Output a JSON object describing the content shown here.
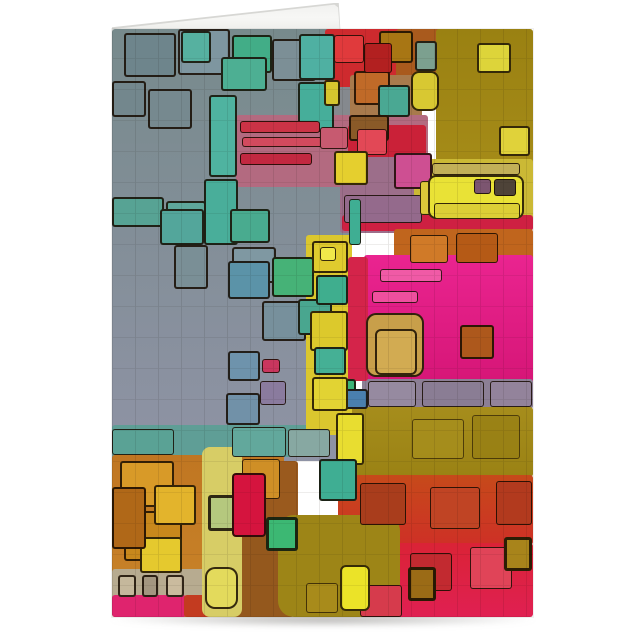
{
  "scene": {
    "description": "Folded greeting card product photo standing upright on a white background; front panel shows abstract posterized artwork of overlapping black-outlined color squares; white back panel peeks above the top fold as a thin wedge; soft shadow under the bottom edge",
    "background_color": "#ffffff",
    "card": {
      "left": 112,
      "top": 29,
      "width": 421,
      "height": 588
    },
    "back_fold": {
      "left": 112,
      "top": 3,
      "width": 230,
      "height": 27,
      "face_color": "#f7f7f5",
      "edge_color": "#d7d7d4"
    },
    "shadow": {
      "left": 110,
      "top": 612,
      "width": 426,
      "height": 15,
      "color": "rgba(118,116,112,0.55)"
    }
  },
  "palette": {
    "slate_gray": "#7b8a8c",
    "lavender_gray": "#8f93a5",
    "teal": "#4fae93",
    "green": "#46b277",
    "blue_gray": "#5b93a8",
    "yellow": "#e5d52f",
    "pale_yellow": "#d7cd66",
    "olive_gold": "#9d8415",
    "orange": "#c0651d",
    "red": "#ce2a2e",
    "crimson": "#d5143e",
    "hot_pink": "#e92390",
    "mauve": "#b36a80",
    "purple_gray": "#8c7f95",
    "tan": "#c89f4a",
    "brown": "#94581d",
    "beige": "#b7ab90",
    "ink_outline": "rgba(22,11,0,0.85)"
  },
  "art": {
    "canvas": {
      "w": 421,
      "h": 588
    },
    "outline": "rgba(22,11,0,0.85)",
    "patches": [
      {
        "x": 0,
        "y": 0,
        "w": 238,
        "h": 432,
        "c": "#778a8c",
        "c2": "#8f93a5"
      },
      {
        "x": 220,
        "y": 0,
        "w": 72,
        "h": 100,
        "c": "#85898e"
      },
      {
        "x": 213,
        "y": 0,
        "w": 82,
        "h": 58,
        "c": "#ce2a2e"
      },
      {
        "x": 284,
        "y": 0,
        "w": 64,
        "h": 48,
        "c": "#a95a1d"
      },
      {
        "x": 324,
        "y": 0,
        "w": 97,
        "h": 192,
        "c": "#9a8112",
        "c2": "#a98f1a"
      },
      {
        "x": 238,
        "y": 46,
        "w": 72,
        "h": 46,
        "c": "#a87a4c"
      },
      {
        "x": 124,
        "y": 86,
        "w": 192,
        "h": 72,
        "c": "#b36a80"
      },
      {
        "x": 236,
        "y": 96,
        "w": 78,
        "h": 34,
        "c": "#ca2138"
      },
      {
        "x": 228,
        "y": 128,
        "w": 88,
        "h": 76,
        "c": "#9c6e8a"
      },
      {
        "x": 302,
        "y": 130,
        "w": 119,
        "h": 64,
        "c": "#cbb935"
      },
      {
        "x": 230,
        "y": 186,
        "w": 191,
        "h": 16,
        "c": "#ce2042"
      },
      {
        "x": 282,
        "y": 200,
        "w": 139,
        "h": 40,
        "c": "#c0651d"
      },
      {
        "x": 252,
        "y": 226,
        "w": 169,
        "h": 128,
        "c": "#ea2490",
        "c2": "#d61677"
      },
      {
        "x": 250,
        "y": 350,
        "w": 171,
        "h": 30,
        "c": "#8c7f95"
      },
      {
        "x": 226,
        "y": 378,
        "w": 195,
        "h": 70,
        "c": "#a68d1c",
        "c2": "#9a8214"
      },
      {
        "x": 226,
        "y": 446,
        "w": 195,
        "h": 70,
        "c": "#c64a1a",
        "c2": "#ce3026"
      },
      {
        "x": 226,
        "y": 514,
        "w": 195,
        "h": 74,
        "c": "#da2336",
        "c2": "#e02052"
      },
      {
        "x": 0,
        "y": 396,
        "w": 206,
        "h": 32,
        "c": "#5f9e96"
      },
      {
        "x": 0,
        "y": 426,
        "w": 172,
        "h": 162,
        "c": "#c07622",
        "c2": "#c98429"
      },
      {
        "x": 0,
        "y": 540,
        "w": 94,
        "h": 30,
        "c": "#b7ab90"
      },
      {
        "x": 0,
        "y": 566,
        "w": 74,
        "h": 22,
        "c": "#df246e"
      },
      {
        "x": 72,
        "y": 566,
        "w": 100,
        "h": 22,
        "c": "#c33b20"
      },
      {
        "x": 118,
        "y": 498,
        "w": 64,
        "h": 90,
        "c": "#94581d"
      },
      {
        "x": 150,
        "y": 432,
        "w": 36,
        "h": 70,
        "c": "#9a5a1e"
      },
      {
        "x": 166,
        "y": 486,
        "w": 122,
        "h": 102,
        "c": "#9d8517",
        "r": 16
      },
      {
        "x": 194,
        "y": 206,
        "w": 46,
        "h": 200,
        "c": "#dbc72e"
      },
      {
        "x": 236,
        "y": 228,
        "w": 20,
        "h": 124,
        "c": "#d4244a"
      },
      {
        "x": 90,
        "y": 418,
        "w": 40,
        "h": 170,
        "c": "#d7cd66",
        "r": 8
      }
    ],
    "blocks": [
      {
        "x": 12,
        "y": 4,
        "w": 52,
        "h": 44,
        "c": "#6e858c"
      },
      {
        "x": 66,
        "y": 0,
        "w": 52,
        "h": 46,
        "c": "#7e96a0"
      },
      {
        "x": 69,
        "y": 2,
        "w": 30,
        "h": 32,
        "c": "#56b1a0"
      },
      {
        "x": 120,
        "y": 6,
        "w": 40,
        "h": 38,
        "c": "#42ad87"
      },
      {
        "x": 109,
        "y": 28,
        "w": 46,
        "h": 34,
        "c": "#4daf93"
      },
      {
        "x": 0,
        "y": 52,
        "w": 34,
        "h": 36,
        "c": "#73878d"
      },
      {
        "x": 36,
        "y": 60,
        "w": 44,
        "h": 40,
        "c": "#76898f"
      },
      {
        "x": 160,
        "y": 10,
        "w": 44,
        "h": 42,
        "c": "#7c8f96"
      },
      {
        "x": 187,
        "y": 5,
        "w": 36,
        "h": 46,
        "c": "#4fb0a2"
      },
      {
        "x": 186,
        "y": 53,
        "w": 36,
        "h": 50,
        "c": "#46ae9a"
      },
      {
        "x": 212,
        "y": 51,
        "w": 16,
        "h": 26,
        "c": "#d6c52e"
      },
      {
        "x": 242,
        "y": 42,
        "w": 36,
        "h": 34,
        "c": "#c06a28"
      },
      {
        "x": 267,
        "y": 2,
        "w": 34,
        "h": 32,
        "c": "#a87614"
      },
      {
        "x": 266,
        "y": 56,
        "w": 32,
        "h": 32,
        "c": "#4aa893"
      },
      {
        "x": 237,
        "y": 86,
        "w": 40,
        "h": 26,
        "c": "#8a5a28"
      },
      {
        "x": 222,
        "y": 6,
        "w": 30,
        "h": 28,
        "c": "#e03a3c",
        "bw": 1
      },
      {
        "x": 252,
        "y": 14,
        "w": 28,
        "h": 30,
        "c": "#b22020",
        "bw": 1
      },
      {
        "x": 365,
        "y": 14,
        "w": 34,
        "h": 30,
        "c": "#ddd43a"
      },
      {
        "x": 387,
        "y": 97,
        "w": 31,
        "h": 30,
        "c": "#e0d23a"
      },
      {
        "x": 303,
        "y": 12,
        "w": 22,
        "h": 30,
        "c": "#7ca08f"
      },
      {
        "x": 299,
        "y": 42,
        "w": 28,
        "h": 40,
        "c": "#d8c832",
        "r": 8
      },
      {
        "x": 0,
        "y": 168,
        "w": 52,
        "h": 30,
        "c": "#57a394"
      },
      {
        "x": 54,
        "y": 172,
        "w": 40,
        "h": 26,
        "c": "#5ea79a"
      },
      {
        "x": 97,
        "y": 66,
        "w": 28,
        "h": 82,
        "c": "#4fb3a0"
      },
      {
        "x": 92,
        "y": 150,
        "w": 34,
        "h": 66,
        "c": "#49ae9a"
      },
      {
        "x": 48,
        "y": 180,
        "w": 44,
        "h": 36,
        "c": "#53a69b"
      },
      {
        "x": 62,
        "y": 216,
        "w": 34,
        "h": 44,
        "c": "#7a8f96"
      },
      {
        "x": 118,
        "y": 180,
        "w": 40,
        "h": 34,
        "c": "#49ab8f"
      },
      {
        "x": 120,
        "y": 218,
        "w": 44,
        "h": 36,
        "c": "#7f98a2"
      },
      {
        "x": 128,
        "y": 92,
        "w": 80,
        "h": 12,
        "c": "#cb3346",
        "bw": 1
      },
      {
        "x": 130,
        "y": 108,
        "w": 88,
        "h": 10,
        "c": "#d24a5e",
        "bw": 1
      },
      {
        "x": 128,
        "y": 124,
        "w": 72,
        "h": 12,
        "c": "#c22840",
        "bw": 1
      },
      {
        "x": 208,
        "y": 98,
        "w": 28,
        "h": 22,
        "c": "#c75a70",
        "bw": 1
      },
      {
        "x": 245,
        "y": 100,
        "w": 30,
        "h": 26,
        "c": "#e24856",
        "bw": 1
      },
      {
        "x": 222,
        "y": 122,
        "w": 34,
        "h": 34,
        "c": "#e5cf2e"
      },
      {
        "x": 282,
        "y": 124,
        "w": 38,
        "h": 36,
        "c": "#ce4f92"
      },
      {
        "x": 232,
        "y": 166,
        "w": 78,
        "h": 28,
        "c": "#946a8c",
        "bw": 1
      },
      {
        "x": 308,
        "y": 152,
        "w": 16,
        "h": 34,
        "c": "#ddc93a",
        "bw": 1
      },
      {
        "x": 237,
        "y": 170,
        "w": 12,
        "h": 46,
        "c": "#3fae93",
        "bw": 1
      },
      {
        "x": 316,
        "y": 146,
        "w": 96,
        "h": 44,
        "c": "#e9e236",
        "r": 8
      },
      {
        "x": 322,
        "y": 174,
        "w": 86,
        "h": 16,
        "c": "#dccf36",
        "bw": 1
      },
      {
        "x": 362,
        "y": 150,
        "w": 17,
        "h": 15,
        "c": "#7c5570",
        "bw": 1
      },
      {
        "x": 382,
        "y": 150,
        "w": 22,
        "h": 17,
        "c": "#4e4338",
        "bw": 1
      },
      {
        "x": 320,
        "y": 134,
        "w": 88,
        "h": 12,
        "c": "#c2b058",
        "bw": 1
      },
      {
        "x": 298,
        "y": 206,
        "w": 38,
        "h": 28,
        "c": "#d07a28",
        "bw": 1
      },
      {
        "x": 344,
        "y": 204,
        "w": 42,
        "h": 30,
        "c": "#b55a16",
        "bw": 1
      },
      {
        "x": 268,
        "y": 240,
        "w": 62,
        "h": 13,
        "c": "#f05aa6",
        "bw": 1
      },
      {
        "x": 260,
        "y": 262,
        "w": 46,
        "h": 12,
        "c": "#ef4f9e",
        "bw": 1
      },
      {
        "x": 254,
        "y": 284,
        "w": 58,
        "h": 64,
        "c": "#c89f4a",
        "r": 10
      },
      {
        "x": 263,
        "y": 300,
        "w": 42,
        "h": 46,
        "c": "#d2ab52",
        "r": 6
      },
      {
        "x": 348,
        "y": 296,
        "w": 34,
        "h": 34,
        "c": "#ad581c"
      },
      {
        "x": 256,
        "y": 352,
        "w": 48,
        "h": 26,
        "c": "#968aa0",
        "bw": 1
      },
      {
        "x": 310,
        "y": 352,
        "w": 62,
        "h": 26,
        "c": "#8a7d94",
        "bw": 1
      },
      {
        "x": 378,
        "y": 352,
        "w": 42,
        "h": 26,
        "c": "#93839b",
        "bw": 1
      },
      {
        "x": 218,
        "y": 350,
        "w": 26,
        "h": 22,
        "c": "#3db377"
      },
      {
        "x": 232,
        "y": 360,
        "w": 24,
        "h": 20,
        "c": "#4a7fae"
      },
      {
        "x": 224,
        "y": 384,
        "w": 28,
        "h": 52,
        "c": "#e8dd30"
      },
      {
        "x": 207,
        "y": 430,
        "w": 38,
        "h": 42,
        "c": "#3fae93"
      },
      {
        "x": 300,
        "y": 390,
        "w": 52,
        "h": 40,
        "c": "#a8901e",
        "bw": 1,
        "o": 0.7
      },
      {
        "x": 360,
        "y": 386,
        "w": 48,
        "h": 44,
        "c": "#977f14",
        "bw": 1,
        "o": 0.7
      },
      {
        "x": 248,
        "y": 454,
        "w": 46,
        "h": 42,
        "c": "#a93d1c",
        "bw": 1
      },
      {
        "x": 318,
        "y": 458,
        "w": 50,
        "h": 42,
        "c": "#c04424",
        "bw": 1
      },
      {
        "x": 384,
        "y": 452,
        "w": 36,
        "h": 44,
        "c": "#b23a1e",
        "bw": 1
      },
      {
        "x": 298,
        "y": 524,
        "w": 42,
        "h": 38,
        "c": "#c22a30",
        "bw": 1
      },
      {
        "x": 358,
        "y": 518,
        "w": 42,
        "h": 42,
        "c": "#e04458",
        "bw": 1
      },
      {
        "x": 392,
        "y": 508,
        "w": 28,
        "h": 34,
        "c": "#a8841b",
        "bw": 3
      },
      {
        "x": 296,
        "y": 538,
        "w": 28,
        "h": 34,
        "c": "#9b6b16",
        "bw": 3
      },
      {
        "x": 248,
        "y": 556,
        "w": 42,
        "h": 32,
        "c": "#d63b4c",
        "bw": 1
      },
      {
        "x": 154,
        "y": 488,
        "w": 32,
        "h": 34,
        "c": "#3cb873",
        "bw": 3
      },
      {
        "x": 228,
        "y": 536,
        "w": 30,
        "h": 46,
        "c": "#ebe328",
        "r": 6
      },
      {
        "x": 194,
        "y": 554,
        "w": 32,
        "h": 30,
        "c": "#ab8d1c",
        "bw": 1,
        "o": 0.8
      },
      {
        "x": 8,
        "y": 432,
        "w": 54,
        "h": 46,
        "c": "#d89a28"
      },
      {
        "x": 12,
        "y": 482,
        "w": 58,
        "h": 50,
        "c": "#c8881c"
      },
      {
        "x": 42,
        "y": 456,
        "w": 42,
        "h": 40,
        "c": "#e3b42c"
      },
      {
        "x": 28,
        "y": 508,
        "w": 42,
        "h": 36,
        "c": "#e5c92e"
      },
      {
        "x": 0,
        "y": 458,
        "w": 34,
        "h": 62,
        "c": "#b06818"
      },
      {
        "x": 130,
        "y": 430,
        "w": 38,
        "h": 40,
        "c": "#cf8f26",
        "bw": 1
      },
      {
        "x": 6,
        "y": 546,
        "w": 18,
        "h": 22,
        "c": "#c5b89c"
      },
      {
        "x": 30,
        "y": 546,
        "w": 16,
        "h": 22,
        "c": "#a39680"
      },
      {
        "x": 54,
        "y": 546,
        "w": 18,
        "h": 22,
        "c": "#cabb9e"
      },
      {
        "x": 96,
        "y": 466,
        "w": 30,
        "h": 36,
        "c": "#b5c87e",
        "bw": 3
      },
      {
        "x": 93,
        "y": 538,
        "w": 33,
        "h": 42,
        "c": "#e3da5c",
        "r": 10
      },
      {
        "x": 120,
        "y": 444,
        "w": 34,
        "h": 64,
        "c": "#d5143e",
        "r": 4
      },
      {
        "x": 0,
        "y": 400,
        "w": 62,
        "h": 26,
        "c": "#5aa295",
        "bw": 1
      },
      {
        "x": 120,
        "y": 398,
        "w": 54,
        "h": 30,
        "c": "#62a89c",
        "bw": 1
      },
      {
        "x": 176,
        "y": 400,
        "w": 42,
        "h": 28,
        "c": "#87a8a2",
        "bw": 1
      },
      {
        "x": 116,
        "y": 322,
        "w": 32,
        "h": 30,
        "c": "#6e93ac"
      },
      {
        "x": 114,
        "y": 364,
        "w": 34,
        "h": 32,
        "c": "#7191a8"
      },
      {
        "x": 150,
        "y": 330,
        "w": 18,
        "h": 14,
        "c": "#c9365e",
        "bw": 1
      },
      {
        "x": 148,
        "y": 352,
        "w": 26,
        "h": 24,
        "c": "#8a7b9e",
        "bw": 1
      },
      {
        "x": 116,
        "y": 232,
        "w": 42,
        "h": 38,
        "c": "#5b93a8"
      },
      {
        "x": 160,
        "y": 228,
        "w": 42,
        "h": 40,
        "c": "#46b277"
      },
      {
        "x": 150,
        "y": 272,
        "w": 44,
        "h": 40,
        "c": "#77909c"
      },
      {
        "x": 186,
        "y": 270,
        "w": 34,
        "h": 36,
        "c": "#49a68f"
      },
      {
        "x": 200,
        "y": 212,
        "w": 36,
        "h": 32,
        "c": "#e0cb2e"
      },
      {
        "x": 208,
        "y": 218,
        "w": 16,
        "h": 14,
        "c": "#f0e84a",
        "bw": 1
      },
      {
        "x": 204,
        "y": 246,
        "w": 32,
        "h": 30,
        "c": "#3fae8e"
      },
      {
        "x": 198,
        "y": 282,
        "w": 38,
        "h": 40,
        "c": "#dcc92c"
      },
      {
        "x": 202,
        "y": 318,
        "w": 32,
        "h": 28,
        "c": "#45b095"
      },
      {
        "x": 200,
        "y": 348,
        "w": 36,
        "h": 34,
        "c": "#e2d333"
      }
    ]
  }
}
